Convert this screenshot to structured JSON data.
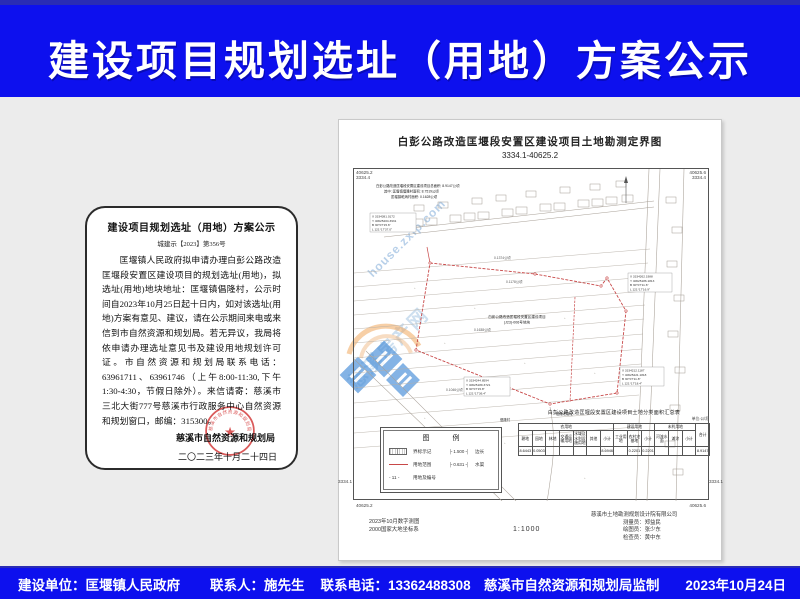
{
  "header": {
    "title": "建设项目规划选址（用地）方案公示"
  },
  "notice": {
    "title": "建设项目规划选址（用地）方案公示",
    "doc_no": "城建示【2023】第356号",
    "body": "匡堰镇人民政府拟申请办理白彭公路改造匡堰段安置区建设项目的规划选址(用地)，拟选址(用地)地块地址：匡堰镇倡隆村，公示时间自2023年10月25日起十日内，如对该选址(用地)方案有意见、建议，请在公示期间来电或来信到市自然资源和规划局。若无异议，我局将依申请办理选址意见书及建设用地规划许可证。市自然资源和规划局联系电话：63961711、63961746（上午8:00-11:30,下午1:30-4:30，节假日除外）。来信请寄：慈溪市三北大街777号慈溪市行政服务中心自然资源和规划窗口，邮编：315300。",
    "signature": "慈溪市自然资源和规划局",
    "date": "二〇二三年十月二十四日",
    "stamp_text": "慈溪市自然资源和规划局"
  },
  "map": {
    "title": "白彭公路改造匡堰段安置区建设项目土地勘测定界图",
    "sheet_no": "3334.1-40625.2",
    "scale": "1:1000",
    "corner_labels": {
      "tl1": "40625.2",
      "tl2": "3334.4",
      "tr1": "40625.6",
      "tr2": "3334.4",
      "bl1": "3334.1",
      "bl2": "40625.2",
      "br1": "3334.1",
      "br2": "40625.6"
    },
    "area_note": {
      "line1": "白彭公路改造匡堰段安置区建设项目总面积: 8.9147公顷",
      "line2": "其中: 匡堰镇倡隆村面积: 8.7519公顷",
      "line3": "匡堰镇乾炳村面积: 0.1628公顷"
    },
    "coord_blocks": [
      {
        "l1": "X 3334381.0172",
        "l2": "Y 40625204.3931",
        "l3": "B 30°07'15.6\"",
        "l4": "L 121°17'37.0\""
      },
      {
        "l1": "X 3334262.1988",
        "l2": "Y 40625186.1813",
        "l3": "B 30°07'11.6\"",
        "l4": "L 121°17'16.9\""
      },
      {
        "l1": "X 3334244.8594",
        "l2": "Y 40625189.3721",
        "l3": "B 30°07'15.8\"",
        "l4": "L 121°17'36.4\""
      },
      {
        "l1": "X 3334212.1187",
        "l2": "Y 40625221.1818",
        "l3": "B 30°07'11.8\"",
        "l4": "L 121°17'18.4\""
      }
    ],
    "center_label1": "白彭公路改造匡堰段安置区建设项目",
    "center_label2": "(J23)-006号地块",
    "area_labels": [
      "0.1374公顷",
      "0.1178公顷",
      "0.1638公顷",
      "0.1046公顷"
    ],
    "place_labels": [
      "倡隆老庙址",
      "倡隆村"
    ],
    "legend": {
      "title": "图　例",
      "rows": [
        {
          "label": "界标示记"
        },
        {
          "label": "用地范围"
        },
        {
          "code": "- 11 -",
          "label": "用地及编号"
        }
      ],
      "rows_right": [
        {
          "code": "├ 1.500 ┤",
          "label": "边长"
        },
        {
          "code": "├ 0.631 ┤",
          "label": "水渠"
        }
      ]
    },
    "table": {
      "title": "白彭公路改造匡堰段安置区建设项目土地分类面积汇总表",
      "unit": "单位:公顷",
      "groups": [
        "农用地",
        "建设用地",
        "未利用地",
        "合计"
      ],
      "leaf_headers": [
        "耕地",
        "园地",
        "林地",
        "交通运输用地",
        "水域及水利设施用地",
        "其他",
        "小计",
        "工业用地",
        "农村宅基地",
        "小计",
        "河流水面",
        "滩涂",
        "小计"
      ],
      "values": [
        "8.6443",
        "0.0503",
        "",
        "",
        "",
        "",
        "8.6946",
        "",
        "0.2201",
        "0.2201",
        "",
        "",
        "",
        "8.9147"
      ]
    },
    "credits": {
      "note1": "2023年10月数字测图",
      "note2": "2000国家大地坐标系",
      "company": "慈溪市土地勘测规划设计院有限公司",
      "staff": [
        "测量员：郑益民",
        "绘图员：张少东",
        "检查员：黄中东"
      ]
    },
    "watermark": {
      "text": "house.zxip.com",
      "cn": "慈溪房产网"
    }
  },
  "footer": {
    "builder": "建设单位：匡堰镇人民政府",
    "contact": "联系人：施先生",
    "phone": "联系电话：13362488308",
    "supervision": "慈溪市自然资源和规划局监制",
    "date": "2023年10月24日"
  },
  "colors": {
    "banner_blue": "#0d10ee",
    "page_bg": "#ececec",
    "stamp_red": "#d43c3c",
    "boundary_red": "#c84848",
    "watermark_blue": "#9ec4e6"
  }
}
